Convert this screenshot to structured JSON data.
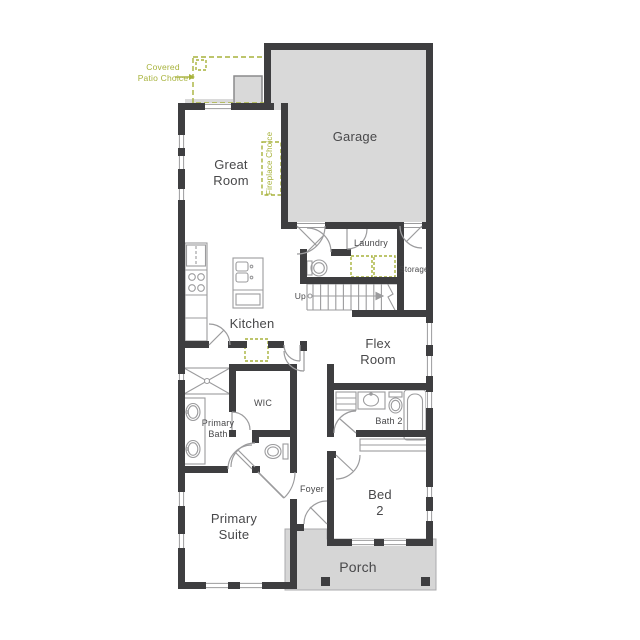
{
  "plan": {
    "rooms": {
      "great_room": "Great Room",
      "garage": "Garage",
      "kitchen": "Kitchen",
      "laundry": "Laundry",
      "storage": "Storage",
      "flex_room": "Flex Room",
      "wic": "WIC",
      "primary_bath": "Primary Bath",
      "bath_2": "Bath 2",
      "foyer": "Foyer",
      "primary_suite": "Primary Suite",
      "bed_2": "Bed 2",
      "porch": "Porch"
    },
    "annotations": {
      "covered_patio_choice": "Covered Patio Choice",
      "fireplace_choice": "Fireplace Choice",
      "stairs_direction": "Up"
    },
    "colors": {
      "wall": "#3E3E40",
      "garage_fill": "#D9D9D9",
      "porch_fill": "#D6D6D6",
      "option_green": "#A7B23B",
      "fixture_gray": "#9B9B9D",
      "label_text": "#48484A",
      "background": "#FFFFFF"
    }
  }
}
